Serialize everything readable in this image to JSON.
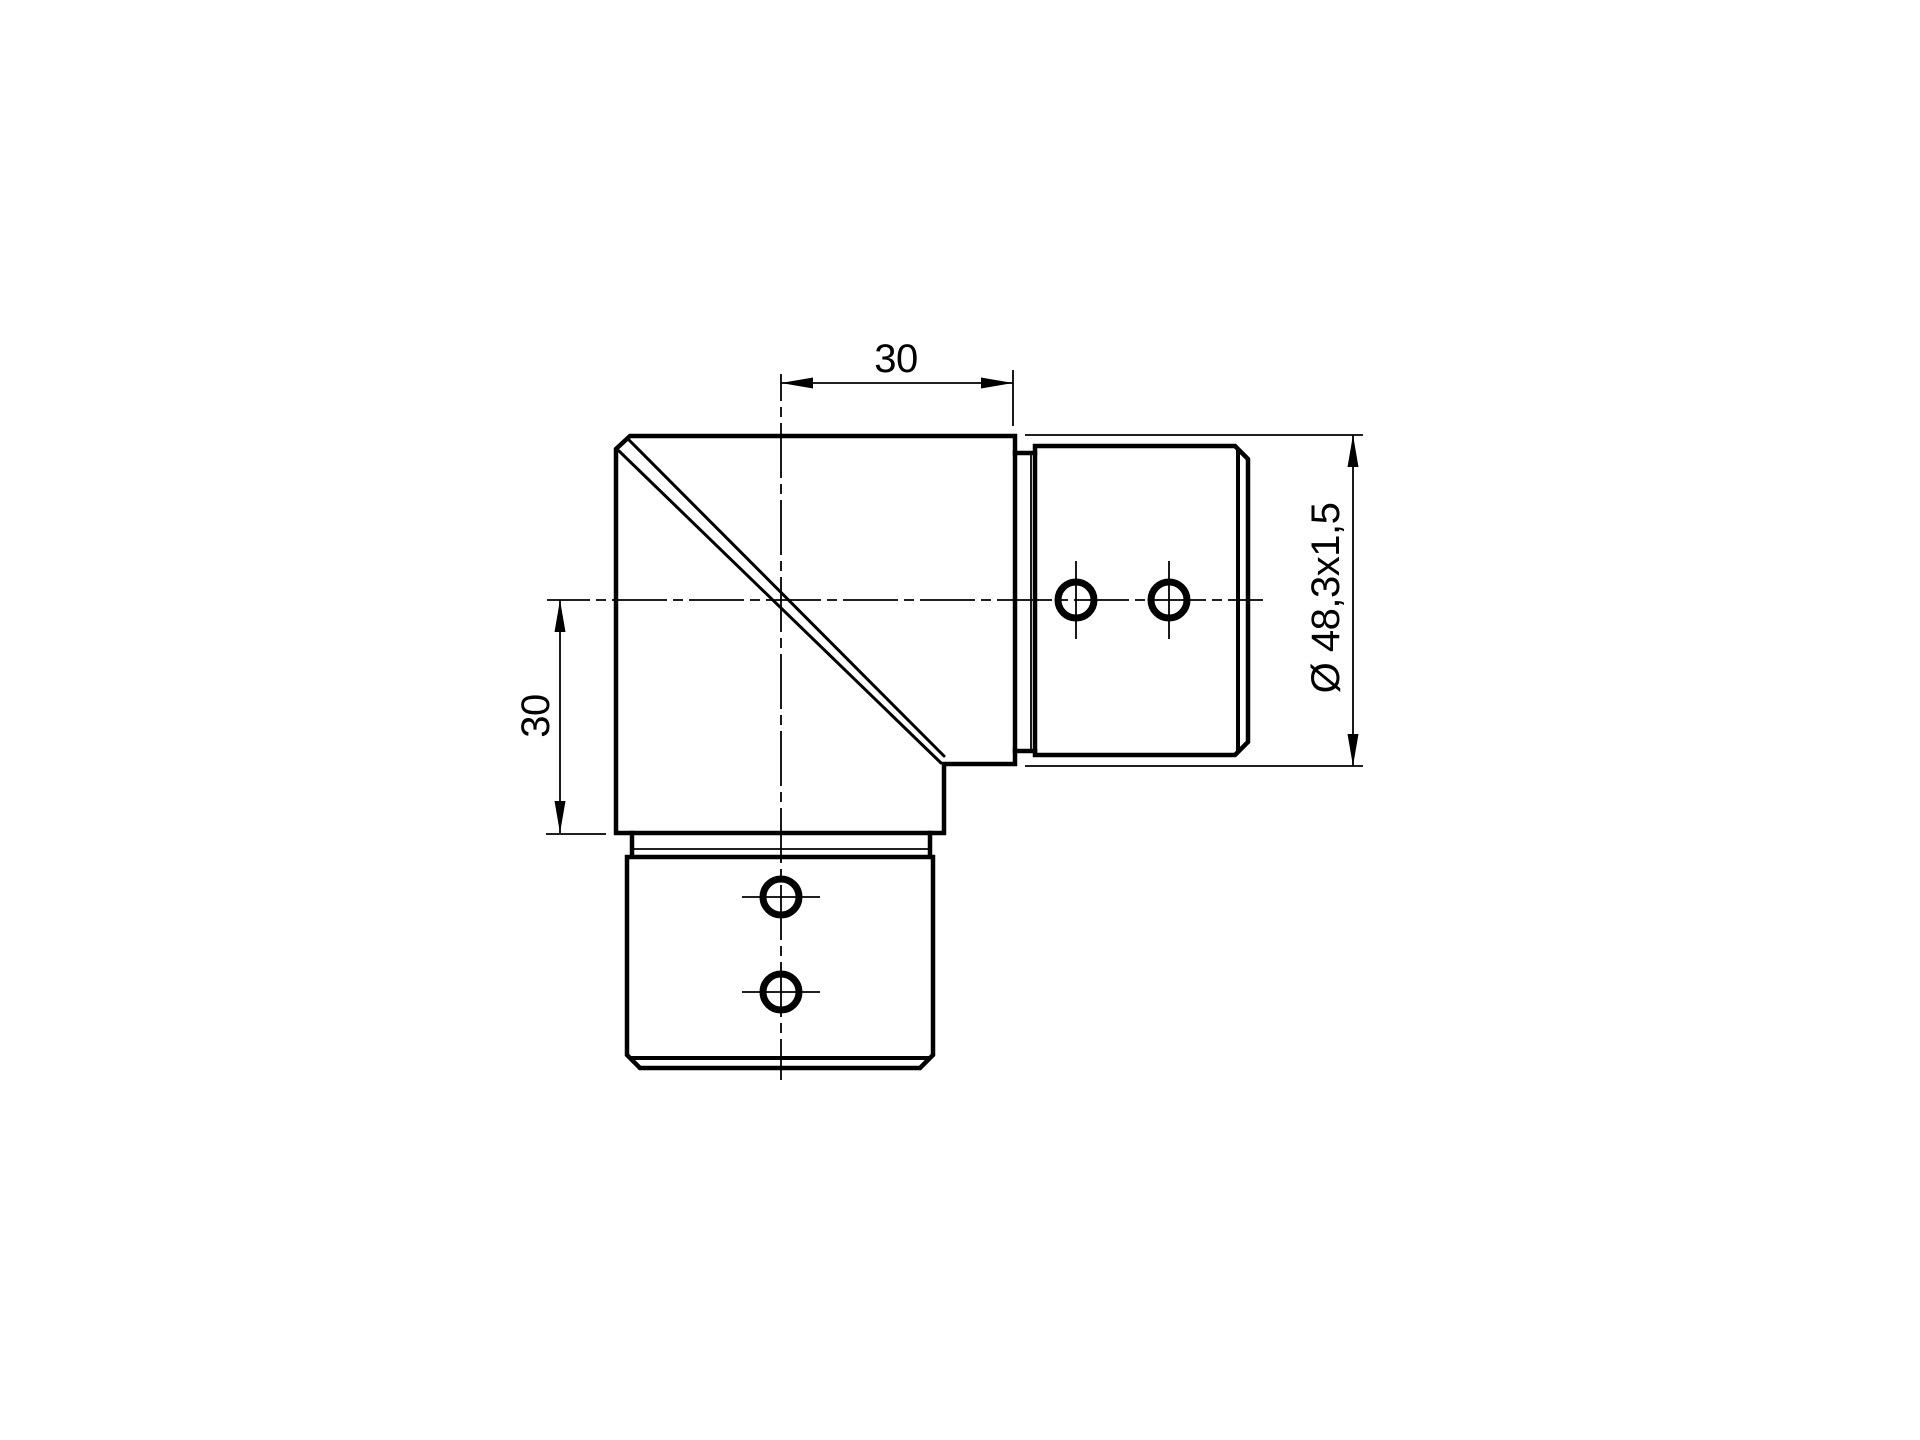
{
  "drawing": {
    "type": "technical-drawing",
    "subject": "90-degree elbow tube connector, side view",
    "dimensions": {
      "top_width": "30",
      "left_height": "30",
      "tube_diameter": "Ø 48,3x1,5"
    },
    "colors": {
      "line": "#000000",
      "background": "#ffffff"
    }
  }
}
